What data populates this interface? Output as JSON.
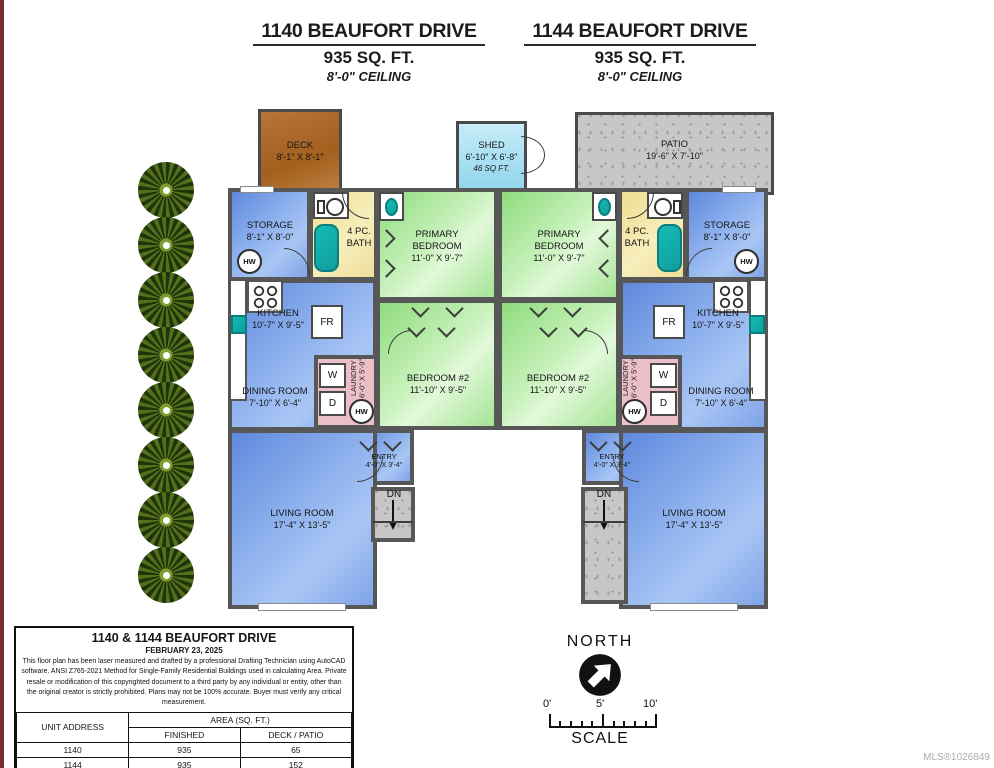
{
  "titles": [
    {
      "address": "1140 BEAUFORT DRIVE",
      "area": "935 SQ. FT.",
      "ceiling": "8'-0\" CEILING"
    },
    {
      "address": "1144 BEAUFORT DRIVE",
      "area": "935 SQ. FT.",
      "ceiling": "8'-0\" CEILING"
    }
  ],
  "outdoor": {
    "deck": {
      "name": "DECK",
      "dims": "8'-1\" X 8'-1\""
    },
    "shed": {
      "name": "SHED",
      "dims": "6'-10\" X 6'-8\"",
      "area": "46 SQ FT."
    },
    "patio": {
      "name": "PATIO",
      "dims": "19'-6\" X 7'-10\""
    }
  },
  "rooms": {
    "storage": {
      "name": "STORAGE",
      "dims": "8'-1\" X 8'-0\""
    },
    "bath": {
      "name": "4 PC. BATH"
    },
    "primary": {
      "name": "PRIMARY BEDROOM",
      "dims": "11'-0\" X 9'-7\""
    },
    "bedroom2": {
      "name": "BEDROOM #2",
      "dims": "11'-10\" X 9'-5\""
    },
    "kitchen": {
      "name": "KITCHEN",
      "dims": "10'-7\" X 9'-5\""
    },
    "dining": {
      "name": "DINING ROOM",
      "dims": "7'-10\" X 6'-4\""
    },
    "living": {
      "name": "LIVING ROOM",
      "dims": "17'-4\" X 13'-5\""
    },
    "laundry": {
      "name": "LAUNDRY",
      "dims": "6'-0\" X 5'-9\""
    },
    "entry": {
      "name": "ENTRY",
      "dims": "4'-0\" X 3'-4\""
    }
  },
  "fixtures": {
    "fr": "FR",
    "w": "W",
    "d": "D",
    "hw": "HW",
    "dn": "DN"
  },
  "info_box": {
    "title": "1140 & 1144 BEAUFORT DRIVE",
    "date": "FEBRUARY 23, 2025",
    "disclaimer": "This floor plan has been laser measured and drafted by a professional Drafting Technician using AutoCAD software. ANSI Z765-2021 Method for Single-Family Residential Buildings used in calculating Area. Private resale or modification of this copyrighted document to a third party by any individual or entity, other than the original creator is strictly prohibited. Plans may not be 100% accurate. Buyer must verify any critical measurement.",
    "table": {
      "col_unit": "UNIT ADDRESS",
      "col_area": "AREA (SQ. FT.)",
      "col_finished": "FINISHED",
      "col_deck": "DECK / PATIO",
      "rows": [
        {
          "unit": "1140",
          "finished": "935",
          "deck": "65"
        },
        {
          "unit": "1144",
          "finished": "935",
          "deck": "152"
        }
      ],
      "total": {
        "label": "TOTAL",
        "finished": "1870",
        "deck": "217"
      }
    }
  },
  "compass": {
    "north": "NORTH",
    "scale": "SCALE",
    "ticks": [
      "0'",
      "5'",
      "10'"
    ]
  },
  "footer": {
    "mls": "MLS®1026849"
  },
  "colors": {
    "wall": "#575757",
    "room_blue": "#6b92e4",
    "room_green": "#9ce08b",
    "room_yellow": "#f2e5a0",
    "room_pink": "#ecbfc8",
    "deck_brown": "#ad6a28",
    "shed_blue": "#a9ddf1",
    "patio_gray": "#c6c6c6",
    "fixture_teal": "#14b8b4"
  }
}
